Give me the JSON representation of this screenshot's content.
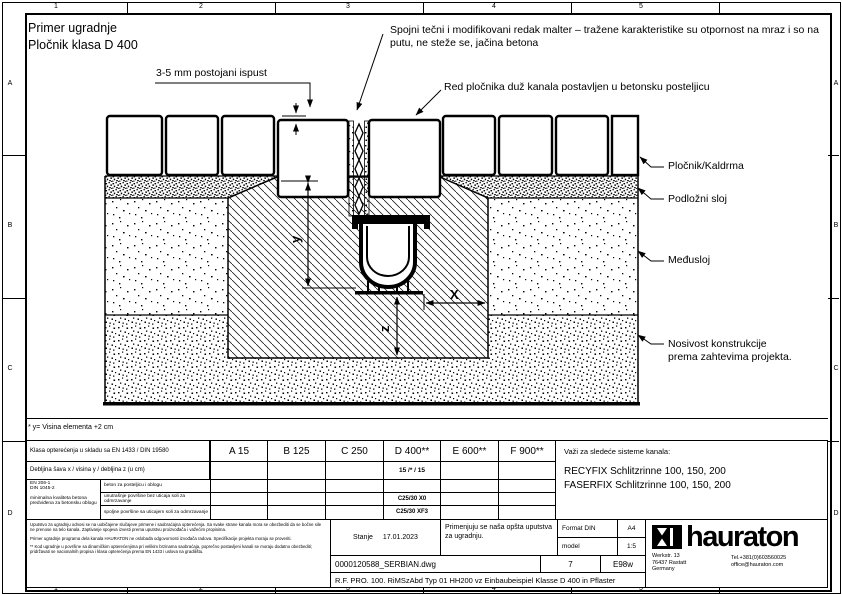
{
  "drawing_header": {
    "title_line1": "Primer ugradnje",
    "title_line2": "Pločnik klasa D 400"
  },
  "annotations": {
    "joint_mortar": "Spojni tečni i modifikovani redak malter – tražene karakteristike su otpornost na mraz i so na putu, ne steže se, jačina betona",
    "gap": "3-5 mm postojani ispust",
    "paver_row": "Red pločnika duž kanala postavljen u betonsku posteljicu",
    "pavement": "Pločnik/Kaldrma",
    "bedding": "Podložni sloj",
    "interlayer": "Međusloj",
    "bearing_line1": "Nosivost konstrukcije",
    "bearing_line2": "prema zahtevima projekta."
  },
  "dimensions": {
    "x": "X",
    "y": "y",
    "z": "z"
  },
  "footnote": "* y= Visina elementa +2 cm",
  "load_table": {
    "class_row_label": "Klasa opterećenja u skladu sa EN 1433 / DIN 19580",
    "classes": [
      "A 15",
      "B 125",
      "C 250",
      "D 400**",
      "E 600**",
      "F 900**"
    ],
    "dims_row_label": "Debljina šava x / visina y / debljina z (u cm)",
    "dims_d400": "15 /* / 15",
    "norm_line1": "EN 206-1",
    "norm_line2": "DIN 1045-2",
    "norm_note": "minimalna kvaliteta betona predviđena za betonsku oblogu",
    "concrete_rows": [
      {
        "label": "beton za posteljicu i oblogu",
        "d400": ""
      },
      {
        "label": "unutrašnje površine bez uticaja soli za odmrzavanje",
        "d400": "C25/30 X0"
      },
      {
        "label": "spoljne površine sa uticajem soli za odmrzavanje",
        "d400": "C25/30 XF3"
      }
    ]
  },
  "systems": {
    "heading": "Važi za sledeće sisteme kanala:",
    "items": [
      "RECYFIX Schlitzrinne 100, 150, 200",
      "FASERFIX Schlitzrinne 100, 150, 200"
    ]
  },
  "title_block": {
    "disclaimer_p1": "Uputstvo za ugradnju odnosi se na uobičajene slučajeve primene i saobraćajna opterećenja. Sa svake strane kanala mora se obezbediti da se bočne sile ne prenose na telo kanala. Zaptivanje spojeva izvesti prema uputstvu proizvođača i važećim propisima.",
    "disclaimer_p2": "Primer ugradnje programa dela kanala HAURATON ne oslobađa odgovornosti izvođača radova. Specifikacije projekta moraju se proveriti.",
    "disclaimer_p3": "** Kod ugradnje u površine sa dinamičkim opterećenjima pri velikim brzinama saobraćaja, poprečno postavljeni kanali se moraju dodatno obezbediti; pridržavati se nacionalnih propisa i klasa opterećenja prema EN 1433 i uslova na gradilištu.",
    "status_label": "Stanje",
    "status_date": "17.01.2023",
    "note": "Primenjuju se naša opšta uputstva za ugradnju.",
    "format_label": "Format DIN",
    "format_value": "A4",
    "scale_label": "model",
    "scale_value": "1:5",
    "code": "E98w",
    "file_name": "0000120588_SERBIAN.dwg",
    "sheet_no": "7",
    "doc_title": "R.F. PRO. 100. RiMSzAbd Typ 01 HH200 vz Einbaubeispiel Klasse D 400 in Pflaster",
    "brand": "hauraton",
    "address_line1": "Werkstr. 13",
    "address_line2": "76437 Rastatt",
    "address_line3": "Germany",
    "phone": "Tel.+381(0)603560025",
    "email": "office@hauraton.com"
  },
  "frame": {
    "cols": [
      "1",
      "2",
      "3",
      "4",
      "5"
    ],
    "rows": [
      "A",
      "B",
      "C",
      "D"
    ]
  }
}
